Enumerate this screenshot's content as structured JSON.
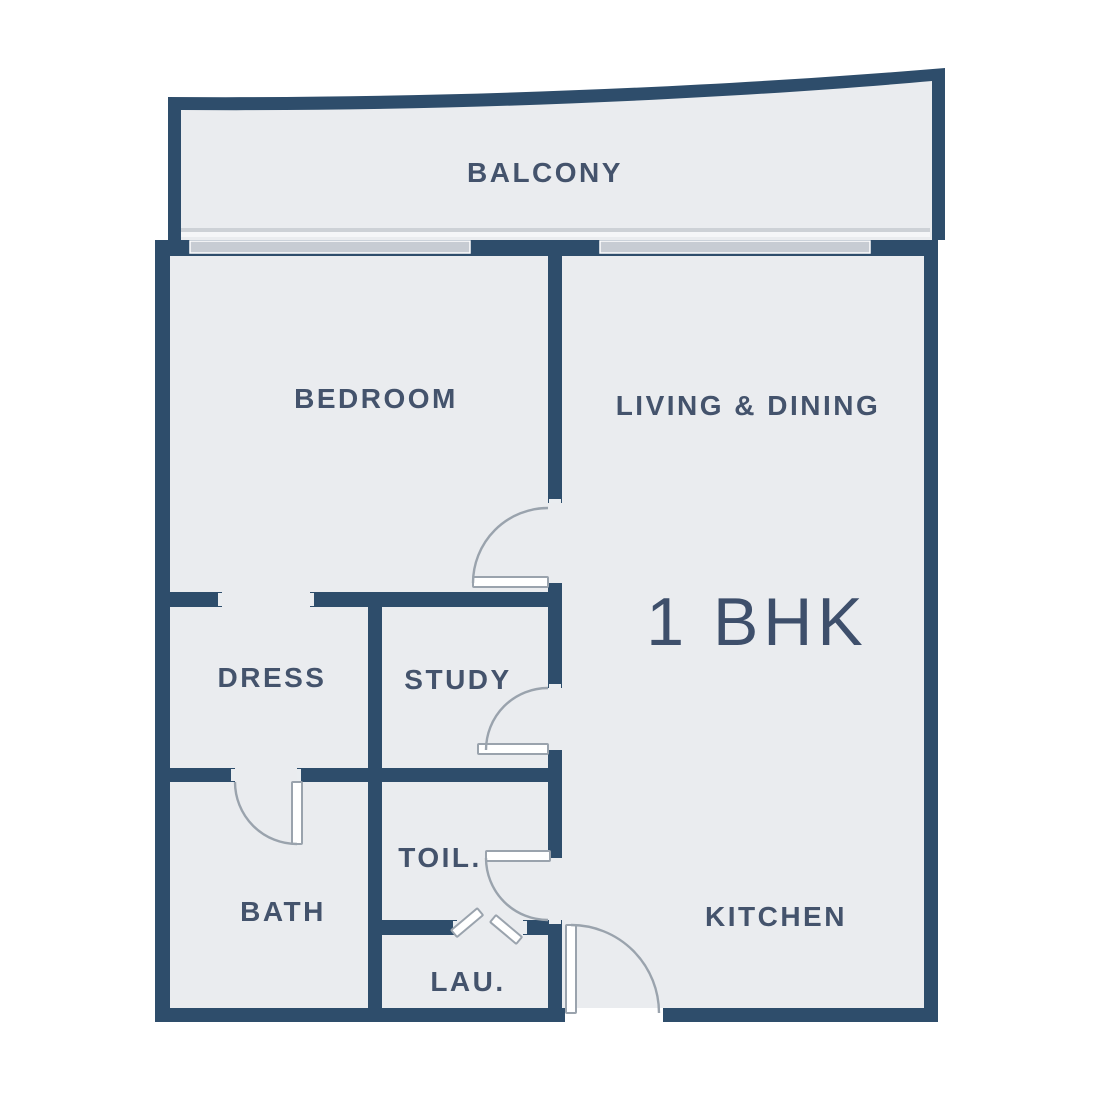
{
  "plan": {
    "label": "1 BHK"
  },
  "rooms": [
    {
      "id": "balcony",
      "label": "BALCONY"
    },
    {
      "id": "bedroom",
      "label": "BEDROOM"
    },
    {
      "id": "living_dining",
      "label": "LIVING & DINING"
    },
    {
      "id": "dress",
      "label": "DRESS"
    },
    {
      "id": "study",
      "label": "STUDY"
    },
    {
      "id": "bath",
      "label": "BATH"
    },
    {
      "id": "toilet",
      "label": "TOIL."
    },
    {
      "id": "laundry",
      "label": "LAU."
    },
    {
      "id": "kitchen",
      "label": "KITCHEN"
    }
  ],
  "colors": {
    "wall": "#2E4D6B",
    "floor": "#EAECEF",
    "window": "#C7CCD3",
    "window_line": "#CDD1D6",
    "window_gap": "#F5F6F8",
    "door": "#9AA3AD",
    "label": "#44536C",
    "plan_label": "#3E4F6B",
    "background": "#FFFFFF"
  }
}
